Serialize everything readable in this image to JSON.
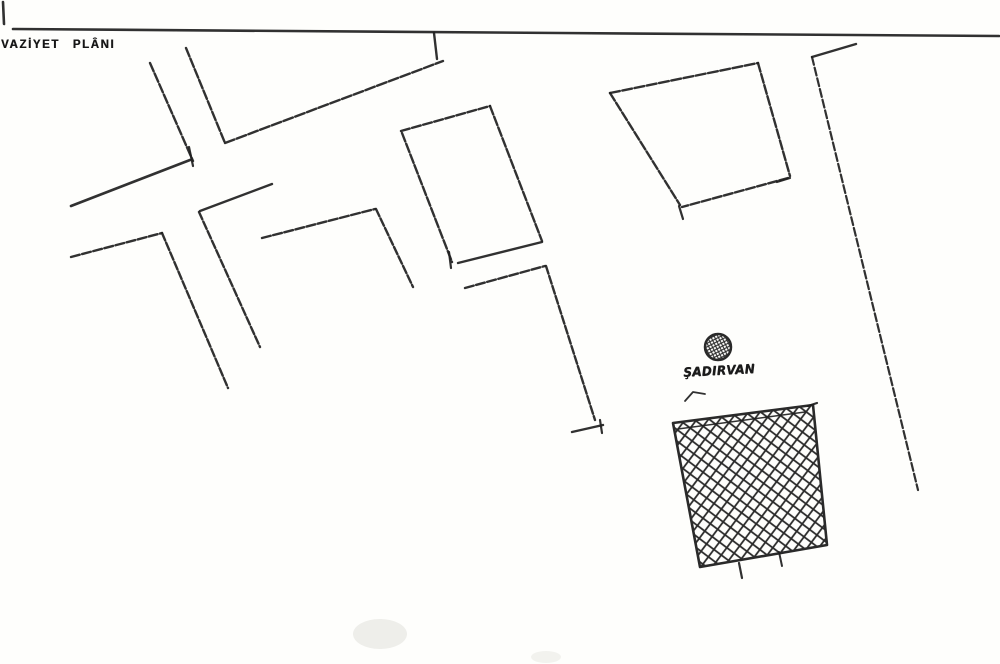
{
  "page": {
    "width": 1000,
    "height": 664,
    "paper_color": "#fefefc",
    "ink_color": "#1f1f1f"
  },
  "title": {
    "text": "VAZİYET PLÂNI"
  },
  "fountain": {
    "label": "ŞADIRVAN",
    "symbol": "crosshatched-circle",
    "cx": 718,
    "cy": 347,
    "r": 13,
    "hatch_spacing": 4.5,
    "hatch_width": 1.1,
    "hatch_angle": 18
  },
  "hatched_block": {
    "symbol": "crosshatched-square",
    "points": [
      [
        673,
        423
      ],
      [
        813,
        405
      ],
      [
        827,
        545
      ],
      [
        700,
        567
      ]
    ],
    "outline_width": 2.6,
    "hatch_spacing": 13,
    "hatch_width": 1.8,
    "hatch_angle": -8
  },
  "smudges": [
    {
      "cx": 380,
      "cy": 634,
      "rx": 27,
      "ry": 15,
      "color": "#eeeeea"
    },
    {
      "cx": 546,
      "cy": 657,
      "rx": 15,
      "ry": 6,
      "color": "#f2f2ee"
    }
  ],
  "strokes": [
    {
      "name": "border-top-line",
      "w": 2.6,
      "pts": [
        [
          13,
          29
        ],
        [
          560,
          33
        ],
        [
          999,
          36
        ]
      ]
    },
    {
      "name": "margin-tick",
      "w": 2.6,
      "pts": [
        [
          3,
          2
        ],
        [
          4,
          24
        ]
      ]
    },
    {
      "name": "street-a-edge1",
      "w": 2.4,
      "dash": "9 2.5",
      "pts": [
        [
          150,
          63
        ],
        [
          193,
          161
        ]
      ]
    },
    {
      "name": "street-a-edge2",
      "w": 2.4,
      "dash": "9 2.5",
      "pts": [
        [
          186,
          48
        ],
        [
          225,
          143
        ]
      ]
    },
    {
      "name": "road-diagonal",
      "w": 2.4,
      "dash": "10 2.5",
      "pts": [
        [
          225,
          143
        ],
        [
          443,
          61
        ]
      ]
    },
    {
      "name": "road-diagonal-riser",
      "w": 2.4,
      "pts": [
        [
          437,
          59
        ],
        [
          434,
          33
        ]
      ]
    },
    {
      "name": "street-b-edge1",
      "w": 2.7,
      "pts": [
        [
          71,
          206
        ],
        [
          190,
          160
        ]
      ]
    },
    {
      "name": "street-b-end-tick",
      "w": 2.2,
      "pts": [
        [
          189,
          147
        ],
        [
          193,
          166
        ]
      ]
    },
    {
      "name": "street-b-edge2",
      "w": 2.4,
      "dash": "9 2.5",
      "pts": [
        [
          71,
          257
        ],
        [
          162,
          233
        ]
      ]
    },
    {
      "name": "street-b-edge2-down",
      "w": 2.4,
      "dash": "8 2.5",
      "pts": [
        [
          162,
          233
        ],
        [
          228,
          388
        ]
      ]
    },
    {
      "name": "street-c-edge",
      "w": 2.4,
      "pts": [
        [
          272,
          184
        ],
        [
          200,
          211
        ]
      ]
    },
    {
      "name": "street-c-down",
      "w": 2.4,
      "dash": "8 2.5",
      "pts": [
        [
          199,
          212
        ],
        [
          260,
          347
        ]
      ]
    },
    {
      "name": "street-d-edge",
      "w": 2.4,
      "dash": "9 2.5",
      "pts": [
        [
          262,
          238
        ],
        [
          375,
          209
        ]
      ]
    },
    {
      "name": "street-d-down",
      "w": 2.4,
      "dash": "8 2.5",
      "pts": [
        [
          376,
          209
        ],
        [
          413,
          287
        ]
      ]
    },
    {
      "name": "street-e-edge",
      "w": 2.4,
      "dash": "9 2.5",
      "pts": [
        [
          465,
          288
        ],
        [
          545,
          266
        ]
      ]
    },
    {
      "name": "street-e-down",
      "w": 2.4,
      "dash": "8 2.5",
      "pts": [
        [
          546,
          266
        ],
        [
          595,
          420
        ]
      ]
    },
    {
      "name": "street-e-foot",
      "w": 2.4,
      "pts": [
        [
          572,
          432
        ],
        [
          603,
          425
        ]
      ]
    },
    {
      "name": "street-e-foot-tick",
      "w": 2.2,
      "pts": [
        [
          600,
          420
        ],
        [
          602,
          433
        ]
      ]
    },
    {
      "name": "building1-top",
      "w": 2.4,
      "dash": "9 2.5",
      "pts": [
        [
          401,
          131
        ],
        [
          490,
          106
        ]
      ]
    },
    {
      "name": "building1-right",
      "w": 2.4,
      "dash": "9 2.5",
      "pts": [
        [
          490,
          106
        ],
        [
          542,
          241
        ]
      ]
    },
    {
      "name": "building1-bottom",
      "w": 2.4,
      "pts": [
        [
          542,
          242
        ],
        [
          458,
          263
        ]
      ]
    },
    {
      "name": "building1-left",
      "w": 2.4,
      "dash": "9 2.5",
      "pts": [
        [
          402,
          133
        ],
        [
          452,
          262
        ]
      ]
    },
    {
      "name": "building1-corner-tick",
      "w": 2.2,
      "pts": [
        [
          449,
          252
        ],
        [
          451,
          268
        ]
      ]
    },
    {
      "name": "building2-top",
      "w": 2.4,
      "dash": "10 2.5",
      "pts": [
        [
          610,
          93
        ],
        [
          758,
          63
        ]
      ]
    },
    {
      "name": "building2-right",
      "w": 2.4,
      "dash": "9 2.5",
      "pts": [
        [
          758,
          63
        ],
        [
          790,
          176
        ]
      ]
    },
    {
      "name": "building2-bottom",
      "w": 2.4,
      "dash": "9 2.5",
      "pts": [
        [
          788,
          178
        ],
        [
          682,
          207
        ]
      ]
    },
    {
      "name": "building2-left",
      "w": 2.4,
      "dash": "9 2.5",
      "pts": [
        [
          610,
          93
        ],
        [
          680,
          205
        ]
      ]
    },
    {
      "name": "building2-tick1",
      "w": 2.2,
      "pts": [
        [
          679,
          206
        ],
        [
          683,
          219
        ]
      ]
    },
    {
      "name": "building2-tick2",
      "w": 2.2,
      "pts": [
        [
          777,
          182
        ],
        [
          790,
          178
        ]
      ]
    },
    {
      "name": "road-right-bend",
      "w": 2.4,
      "pts": [
        [
          856,
          44
        ],
        [
          812,
          57
        ]
      ]
    },
    {
      "name": "road-right",
      "w": 2.2,
      "dash": "8 3",
      "pts": [
        [
          812,
          57
        ],
        [
          918,
          490
        ]
      ]
    },
    {
      "name": "label-flourish",
      "w": 1.8,
      "pts": [
        [
          705,
          394
        ],
        [
          693,
          392
        ],
        [
          685,
          401
        ]
      ]
    },
    {
      "name": "block-bottom-tick1",
      "w": 2.2,
      "pts": [
        [
          739,
          563
        ],
        [
          742,
          578
        ]
      ]
    },
    {
      "name": "block-bottom-tick2",
      "w": 2.0,
      "pts": [
        [
          779,
          552
        ],
        [
          782,
          566
        ]
      ]
    },
    {
      "name": "block-top-double-line",
      "w": 1.4,
      "pts": [
        [
          678,
          429
        ],
        [
          805,
          412
        ]
      ]
    },
    {
      "name": "block-corner-overshoot",
      "w": 2.2,
      "pts": [
        [
          808,
          406
        ],
        [
          817,
          403
        ]
      ]
    }
  ]
}
